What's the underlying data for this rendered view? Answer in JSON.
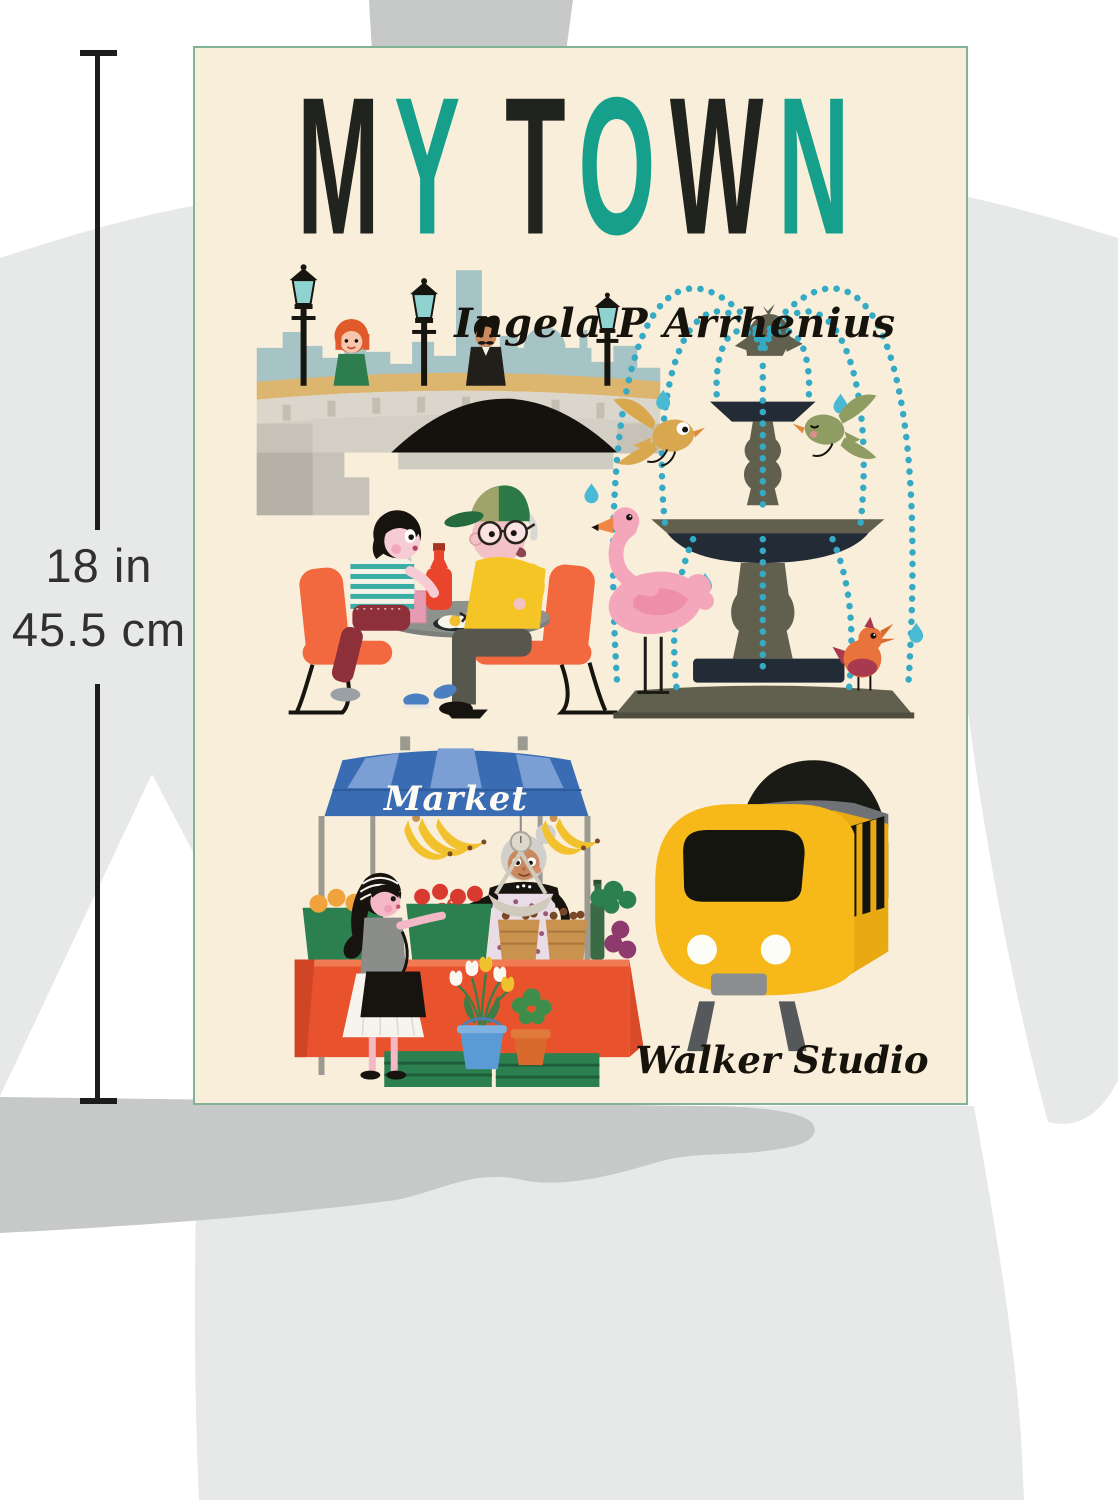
{
  "size_indicator": {
    "inches": "18 in",
    "cm": "45.5 cm"
  },
  "book_cover": {
    "title": "MY TOWN",
    "title_letters": [
      {
        "ch": "M",
        "color": "#20231e"
      },
      {
        "ch": "Y",
        "color": "#16a08c"
      },
      {
        "ch": " "
      },
      {
        "ch": "T",
        "color": "#20231e"
      },
      {
        "ch": "O",
        "color": "#16a08c"
      },
      {
        "ch": "W",
        "color": "#20231e"
      },
      {
        "ch": "N",
        "color": "#16a08c"
      }
    ],
    "author": "Ingela P Arrhenius",
    "publisher": "Walker Studio",
    "market_sign": "Market",
    "background": "#f9eeda",
    "border_color": "#83b397",
    "accent_teal": "#16a08c",
    "title_dark": "#20231e",
    "scenes": [
      "bridge-with-city-skyline",
      "fountain-with-birds-and-flamingo",
      "grandfather-and-child-at-cafe",
      "market-stall",
      "yellow-train"
    ]
  },
  "silhouette_colors": {
    "light": "#e7e8e8",
    "dark": "#c7c9c9"
  }
}
